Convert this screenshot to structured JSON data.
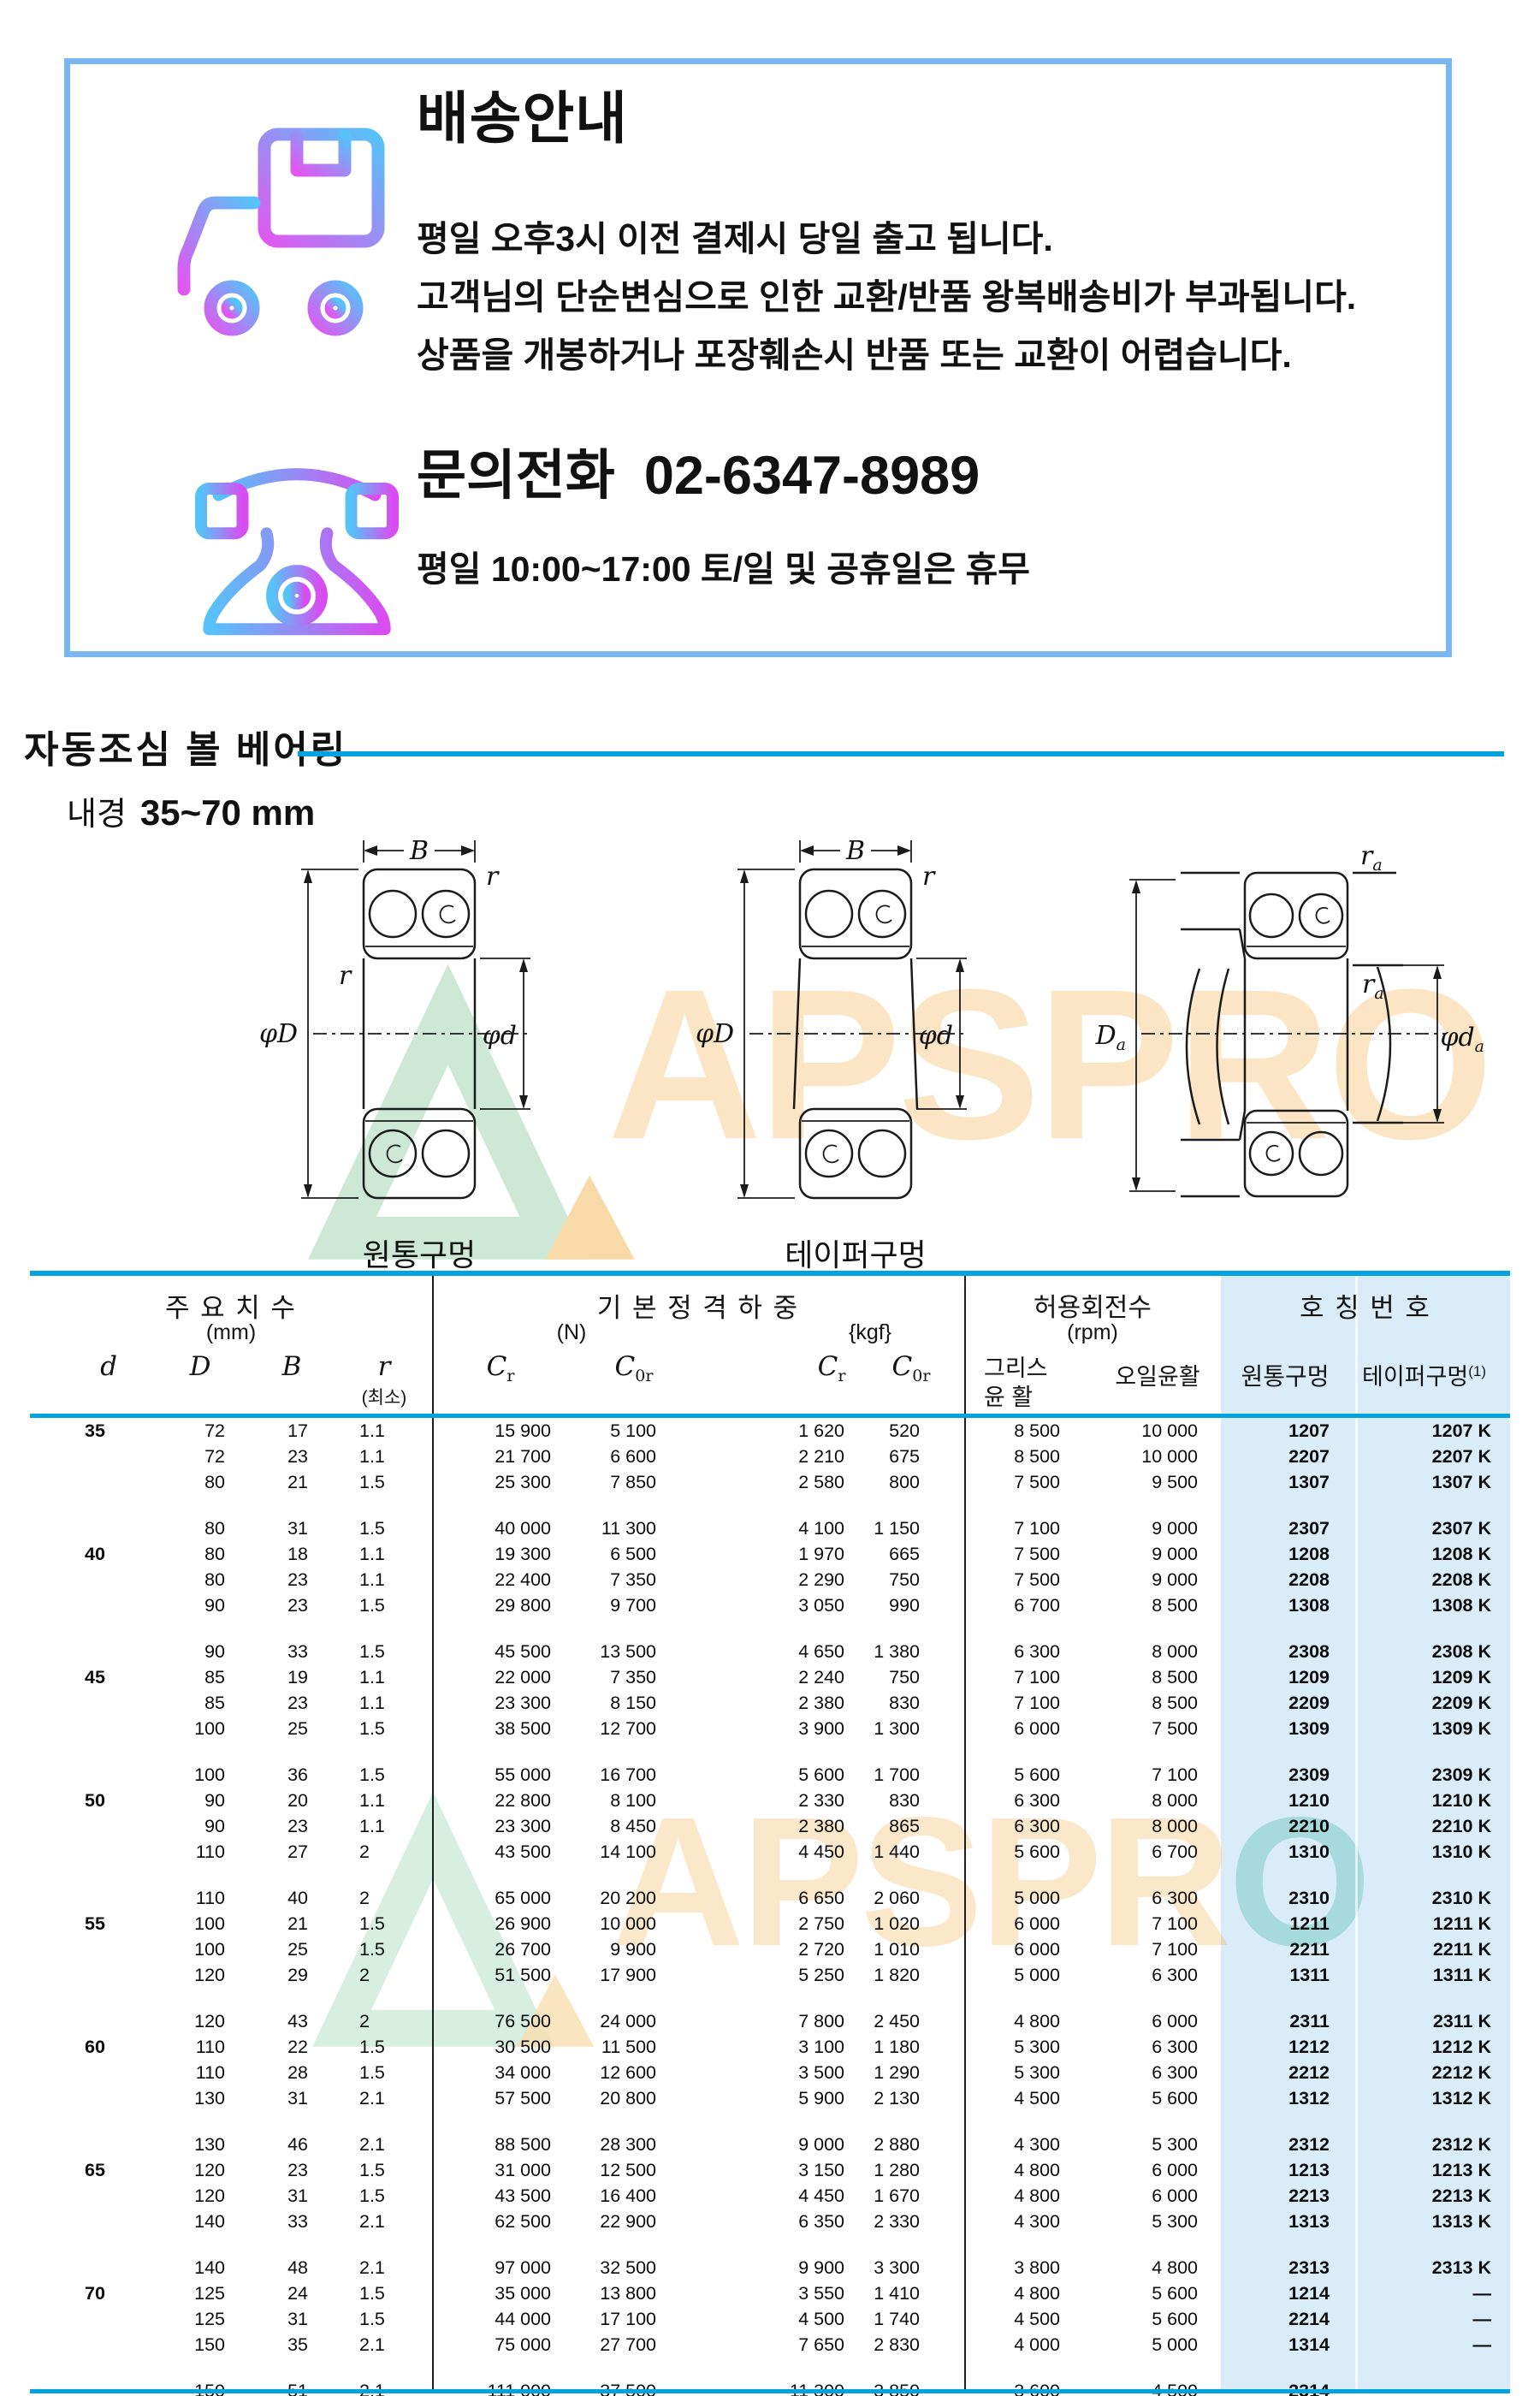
{
  "info_box": {
    "title": "배송안내",
    "delivery_lines": [
      "평일 오후3시 이전 결제시 당일 출고 됩니다.",
      "고객님의 단순변심으로 인한 교환/반품 왕복배송비가 부과됩니다.",
      "상품을 개봉하거나 포장훼손시 반품 또는 교환이 어렵습니다."
    ],
    "phone_label": "문의전화",
    "phone_number": "02-6347-8989",
    "hours": "평일 10:00~17:00 토/일 및 공휴일은 휴무",
    "icons": {
      "truck": "delivery-truck-icon",
      "phone": "telephone-icon"
    },
    "colors": {
      "border": "#7ab6f2",
      "icon_gradient_start": "#e058f0",
      "icon_gradient_end": "#56c3f8"
    }
  },
  "section": {
    "title": "자동조심 볼 베어링",
    "subtitle_label": "내경",
    "subtitle_value": "35~70 mm",
    "rule_color": "#00a3e0"
  },
  "watermark": {
    "text": "APSPRO",
    "text_head": "APSPR",
    "text_tail": "O"
  },
  "diagrams": {
    "b": "B",
    "r": "r",
    "phiD": "φD",
    "phid": "φd",
    "ra": {
      "c": "r",
      "s": "a"
    },
    "phiDa": {
      "c": "φD",
      "s": "a"
    },
    "phida": {
      "c": "φd",
      "s": "a"
    },
    "caption_cyl": "원통구멍",
    "caption_taper": "테이퍼구멍"
  },
  "table": {
    "colors": {
      "line": "#00a3e0",
      "highlight_bg": "#d9ecf8"
    },
    "header": {
      "dims": "주 요 치 수",
      "dims_unit": "(mm)",
      "load": "기 본 정 격 하 중",
      "load_n": "(N)",
      "load_kgf": "{kgf}",
      "speed": "허용회전수",
      "speed_unit": "(rpm)",
      "number": "호 칭 번 호",
      "d": "d",
      "D": "D",
      "B": "B",
      "r": "r",
      "r_min": "(최소)",
      "cr": {
        "c": "C",
        "s": "r"
      },
      "c0r": {
        "c": "C",
        "s": "0r"
      },
      "grease1": "그리스",
      "grease2": "윤 활",
      "oil": "오일윤활",
      "cyl": "원통구멍",
      "taper": "테이퍼구멍",
      "taper_sup": "(1)"
    },
    "rows": [
      {
        "d": "35",
        "D": "72",
        "B": "17",
        "r": "1.1",
        "crn": "15 900",
        "c0rn": "5 100",
        "crk": "1 620",
        "c0rk": "520",
        "g": "8 500",
        "o": "10 000",
        "cyl": "1207",
        "tap": "1207 K"
      },
      {
        "d": "",
        "D": "72",
        "B": "23",
        "r": "1.1",
        "crn": "21 700",
        "c0rn": "6 600",
        "crk": "2 210",
        "c0rk": "675",
        "g": "8 500",
        "o": "10 000",
        "cyl": "2207",
        "tap": "2207 K"
      },
      {
        "d": "",
        "D": "80",
        "B": "21",
        "r": "1.5",
        "crn": "25 300",
        "c0rn": "7 850",
        "crk": "2 580",
        "c0rk": "800",
        "g": "7 500",
        "o": "9 500",
        "cyl": "1307",
        "tap": "1307 K"
      },
      {
        "d": "",
        "D": "80",
        "B": "31",
        "r": "1.5",
        "crn": "40 000",
        "c0rn": "11 300",
        "crk": "4 100",
        "c0rk": "1 150",
        "g": "7 100",
        "o": "9 000",
        "cyl": "2307",
        "tap": "2307 K"
      },
      {
        "d": "40",
        "D": "80",
        "B": "18",
        "r": "1.1",
        "crn": "19 300",
        "c0rn": "6 500",
        "crk": "1 970",
        "c0rk": "665",
        "g": "7 500",
        "o": "9 000",
        "cyl": "1208",
        "tap": "1208 K"
      },
      {
        "d": "",
        "D": "80",
        "B": "23",
        "r": "1.1",
        "crn": "22 400",
        "c0rn": "7 350",
        "crk": "2 290",
        "c0rk": "750",
        "g": "7 500",
        "o": "9 000",
        "cyl": "2208",
        "tap": "2208 K"
      },
      {
        "d": "",
        "D": "90",
        "B": "23",
        "r": "1.5",
        "crn": "29 800",
        "c0rn": "9 700",
        "crk": "3 050",
        "c0rk": "990",
        "g": "6 700",
        "o": "8 500",
        "cyl": "1308",
        "tap": "1308 K"
      },
      {
        "d": "",
        "D": "90",
        "B": "33",
        "r": "1.5",
        "crn": "45 500",
        "c0rn": "13 500",
        "crk": "4 650",
        "c0rk": "1 380",
        "g": "6 300",
        "o": "8 000",
        "cyl": "2308",
        "tap": "2308 K"
      },
      {
        "d": "45",
        "D": "85",
        "B": "19",
        "r": "1.1",
        "crn": "22 000",
        "c0rn": "7 350",
        "crk": "2 240",
        "c0rk": "750",
        "g": "7 100",
        "o": "8 500",
        "cyl": "1209",
        "tap": "1209 K"
      },
      {
        "d": "",
        "D": "85",
        "B": "23",
        "r": "1.1",
        "crn": "23 300",
        "c0rn": "8 150",
        "crk": "2 380",
        "c0rk": "830",
        "g": "7 100",
        "o": "8 500",
        "cyl": "2209",
        "tap": "2209 K"
      },
      {
        "d": "",
        "D": "100",
        "B": "25",
        "r": "1.5",
        "crn": "38 500",
        "c0rn": "12 700",
        "crk": "3 900",
        "c0rk": "1 300",
        "g": "6 000",
        "o": "7 500",
        "cyl": "1309",
        "tap": "1309 K"
      },
      {
        "d": "",
        "D": "100",
        "B": "36",
        "r": "1.5",
        "crn": "55 000",
        "c0rn": "16 700",
        "crk": "5 600",
        "c0rk": "1 700",
        "g": "5 600",
        "o": "7 100",
        "cyl": "2309",
        "tap": "2309 K"
      },
      {
        "d": "50",
        "D": "90",
        "B": "20",
        "r": "1.1",
        "crn": "22 800",
        "c0rn": "8 100",
        "crk": "2 330",
        "c0rk": "830",
        "g": "6 300",
        "o": "8 000",
        "cyl": "1210",
        "tap": "1210 K"
      },
      {
        "d": "",
        "D": "90",
        "B": "23",
        "r": "1.1",
        "crn": "23 300",
        "c0rn": "8 450",
        "crk": "2 380",
        "c0rk": "865",
        "g": "6 300",
        "o": "8 000",
        "cyl": "2210",
        "tap": "2210 K"
      },
      {
        "d": "",
        "D": "110",
        "B": "27",
        "r": "2",
        "crn": "43 500",
        "c0rn": "14 100",
        "crk": "4 450",
        "c0rk": "1 440",
        "g": "5 600",
        "o": "6 700",
        "cyl": "1310",
        "tap": "1310 K"
      },
      {
        "d": "",
        "D": "110",
        "B": "40",
        "r": "2",
        "crn": "65 000",
        "c0rn": "20 200",
        "crk": "6 650",
        "c0rk": "2 060",
        "g": "5 000",
        "o": "6 300",
        "cyl": "2310",
        "tap": "2310 K"
      },
      {
        "d": "55",
        "D": "100",
        "B": "21",
        "r": "1.5",
        "crn": "26 900",
        "c0rn": "10 000",
        "crk": "2 750",
        "c0rk": "1 020",
        "g": "6 000",
        "o": "7 100",
        "cyl": "1211",
        "tap": "1211 K"
      },
      {
        "d": "",
        "D": "100",
        "B": "25",
        "r": "1.5",
        "crn": "26 700",
        "c0rn": "9 900",
        "crk": "2 720",
        "c0rk": "1 010",
        "g": "6 000",
        "o": "7 100",
        "cyl": "2211",
        "tap": "2211 K"
      },
      {
        "d": "",
        "D": "120",
        "B": "29",
        "r": "2",
        "crn": "51 500",
        "c0rn": "17 900",
        "crk": "5 250",
        "c0rk": "1 820",
        "g": "5 000",
        "o": "6 300",
        "cyl": "1311",
        "tap": "1311 K"
      },
      {
        "d": "",
        "D": "120",
        "B": "43",
        "r": "2",
        "crn": "76 500",
        "c0rn": "24 000",
        "crk": "7 800",
        "c0rk": "2 450",
        "g": "4 800",
        "o": "6 000",
        "cyl": "2311",
        "tap": "2311 K"
      },
      {
        "d": "60",
        "D": "110",
        "B": "22",
        "r": "1.5",
        "crn": "30 500",
        "c0rn": "11 500",
        "crk": "3 100",
        "c0rk": "1 180",
        "g": "5 300",
        "o": "6 300",
        "cyl": "1212",
        "tap": "1212 K"
      },
      {
        "d": "",
        "D": "110",
        "B": "28",
        "r": "1.5",
        "crn": "34 000",
        "c0rn": "12 600",
        "crk": "3 500",
        "c0rk": "1 290",
        "g": "5 300",
        "o": "6 300",
        "cyl": "2212",
        "tap": "2212 K"
      },
      {
        "d": "",
        "D": "130",
        "B": "31",
        "r": "2.1",
        "crn": "57 500",
        "c0rn": "20 800",
        "crk": "5 900",
        "c0rk": "2 130",
        "g": "4 500",
        "o": "5 600",
        "cyl": "1312",
        "tap": "1312 K"
      },
      {
        "d": "",
        "D": "130",
        "B": "46",
        "r": "2.1",
        "crn": "88 500",
        "c0rn": "28 300",
        "crk": "9 000",
        "c0rk": "2 880",
        "g": "4 300",
        "o": "5 300",
        "cyl": "2312",
        "tap": "2312 K"
      },
      {
        "d": "65",
        "D": "120",
        "B": "23",
        "r": "1.5",
        "crn": "31 000",
        "c0rn": "12 500",
        "crk": "3 150",
        "c0rk": "1 280",
        "g": "4 800",
        "o": "6 000",
        "cyl": "1213",
        "tap": "1213 K"
      },
      {
        "d": "",
        "D": "120",
        "B": "31",
        "r": "1.5",
        "crn": "43 500",
        "c0rn": "16 400",
        "crk": "4 450",
        "c0rk": "1 670",
        "g": "4 800",
        "o": "6 000",
        "cyl": "2213",
        "tap": "2213 K"
      },
      {
        "d": "",
        "D": "140",
        "B": "33",
        "r": "2.1",
        "crn": "62 500",
        "c0rn": "22 900",
        "crk": "6 350",
        "c0rk": "2 330",
        "g": "4 300",
        "o": "5 300",
        "cyl": "1313",
        "tap": "1313 K"
      },
      {
        "d": "",
        "D": "140",
        "B": "48",
        "r": "2.1",
        "crn": "97 000",
        "c0rn": "32 500",
        "crk": "9 900",
        "c0rk": "3 300",
        "g": "3 800",
        "o": "4 800",
        "cyl": "2313",
        "tap": "2313 K"
      },
      {
        "d": "70",
        "D": "125",
        "B": "24",
        "r": "1.5",
        "crn": "35 000",
        "c0rn": "13 800",
        "crk": "3 550",
        "c0rk": "1 410",
        "g": "4 800",
        "o": "5 600",
        "cyl": "1214",
        "tap": "—"
      },
      {
        "d": "",
        "D": "125",
        "B": "31",
        "r": "1.5",
        "crn": "44 000",
        "c0rn": "17 100",
        "crk": "4 500",
        "c0rk": "1 740",
        "g": "4 500",
        "o": "5 600",
        "cyl": "2214",
        "tap": "—"
      },
      {
        "d": "",
        "D": "150",
        "B": "35",
        "r": "2.1",
        "crn": "75 000",
        "c0rn": "27 700",
        "crk": "7 650",
        "c0rk": "2 830",
        "g": "4 000",
        "o": "5 000",
        "cyl": "1314",
        "tap": "—"
      },
      {
        "d": "",
        "D": "150",
        "B": "51",
        "r": "2.1",
        "crn": "111 000",
        "c0rn": "37 500",
        "crk": "11 300",
        "c0rk": "3 850",
        "g": "3 600",
        "o": "4 500",
        "cyl": "2314",
        "tap": "—"
      }
    ]
  }
}
